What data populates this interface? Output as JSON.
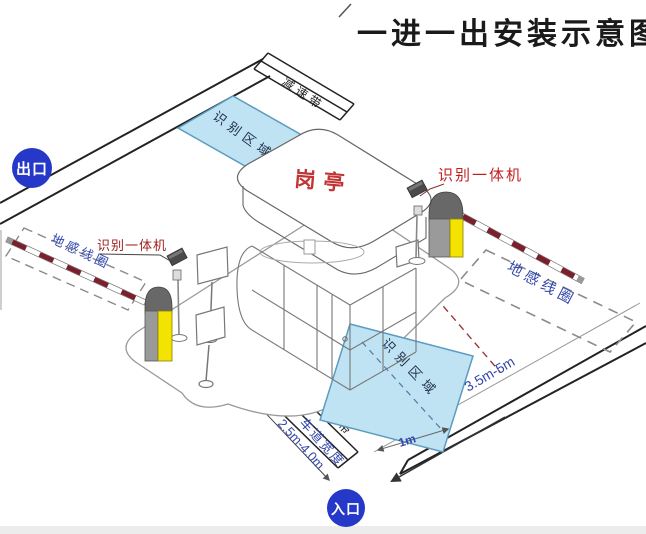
{
  "title": "一进一出安装示意图",
  "badges": {
    "exit": "出口",
    "entrance": "入口"
  },
  "booth": {
    "label": "岗亭"
  },
  "labels": {
    "camera_unit": "识别一体机",
    "ground_coil": "地感线圈",
    "recognition_zone": "识别区域",
    "speed_bump": "减速带",
    "lane_width": "车道宽度",
    "lane_width_value": "2.5m-4.0m"
  },
  "dims": {
    "zone_to_barrier": "3.5m-5m",
    "coil_length": "1m"
  },
  "colors": {
    "badge_blue": "#2638c8",
    "zone_fill": "#bfe3f3",
    "zone_stroke": "#5b9cc0",
    "arm_red": "#7a1f2b",
    "machine_yellow": "#f2e300",
    "machine_gray": "#9a9a9a",
    "label_red": "#a02222",
    "hand_blue": "#3347ad",
    "line_dark": "#222222"
  }
}
